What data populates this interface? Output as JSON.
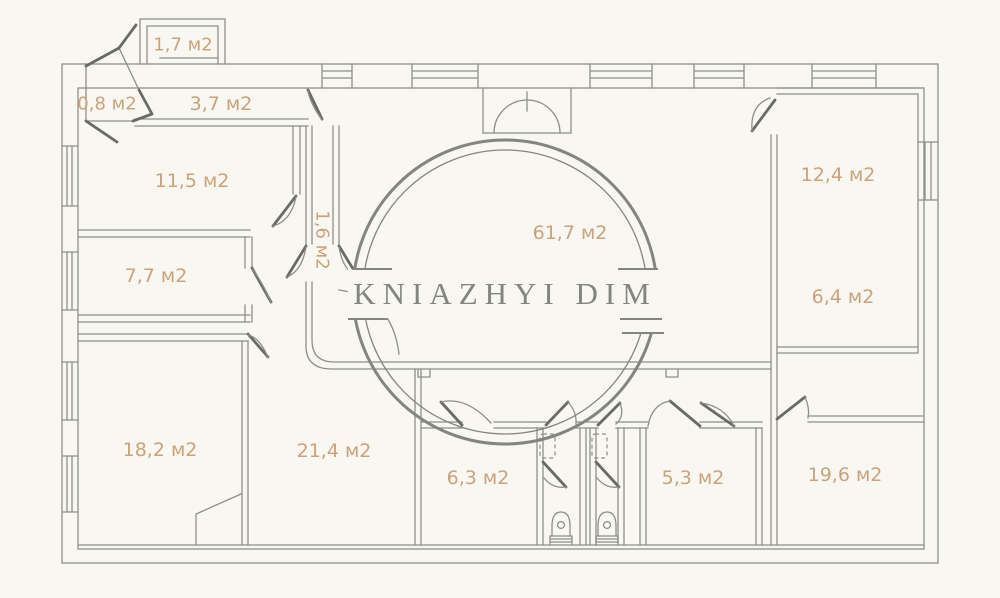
{
  "watermark": {
    "text": "KNIAZHYI DIM"
  },
  "unit_suffix": "м2",
  "colors": {
    "background": "#f8f7f2",
    "wall": "#8f8f8a",
    "door": "#6b6b66",
    "label": "#cba37a",
    "watermark": "#85857f"
  },
  "rooms": [
    {
      "id": "balcony",
      "label": "1,7 м2"
    },
    {
      "id": "vestibule",
      "label": "0,8 м2"
    },
    {
      "id": "hallway",
      "label": "3,7 м2"
    },
    {
      "id": "room-11-5",
      "label": "11,5 м2"
    },
    {
      "id": "room-7-7",
      "label": "7,7 м2"
    },
    {
      "id": "corridor-1-6",
      "label": "1,6 м2"
    },
    {
      "id": "living-61-7",
      "label": "61,7 м2"
    },
    {
      "id": "room-12-4",
      "label": "12,4 м2"
    },
    {
      "id": "room-6-4",
      "label": "6,4 м2"
    },
    {
      "id": "room-18-2",
      "label": "18,2 м2"
    },
    {
      "id": "room-21-4",
      "label": "21,4 м2"
    },
    {
      "id": "room-6-3",
      "label": "6,3 м2"
    },
    {
      "id": "room-5-3",
      "label": "5,3 м2"
    },
    {
      "id": "room-19-6",
      "label": "19,6 м2"
    }
  ]
}
